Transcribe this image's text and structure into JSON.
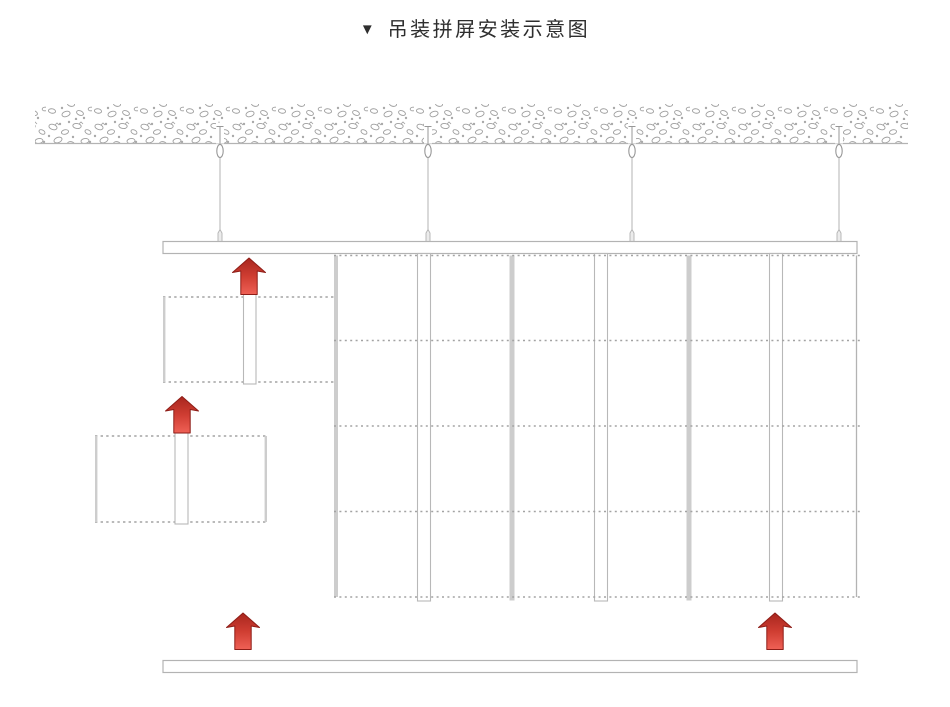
{
  "title": {
    "marker": "▼",
    "text": "吊装拼屏安装示意图"
  },
  "colors": {
    "background": "#ffffff",
    "line": "#b3b3b3",
    "dash": "#a3a3a3",
    "gray_fill": "#cdcdcd",
    "texture": "#9e9e9e",
    "rail_stroke": "#b8b8b8",
    "anchor": "#979797",
    "arrow_dark": "#a8261e",
    "arrow_mid": "#cf3d32",
    "arrow_light": "#ef6156",
    "arrow_stroke": "#8e1d17"
  },
  "diagram": {
    "ceiling": {
      "x": 35,
      "y": 104,
      "width": 873,
      "height": 39
    },
    "hangers": {
      "xs": [
        220,
        428,
        632,
        839
      ],
      "pin_top_y": 126.5,
      "ceiling_line_y": 143.5,
      "eyebolt_cy": 151,
      "eyebolt_ry": 6.6,
      "rod_bottom_y": 232,
      "ferrule_top_y": 229.5,
      "ferrule_bottom_y": 242.5
    },
    "suspension_beam": {
      "x": 163,
      "y": 241.5,
      "width": 694,
      "height": 12
    },
    "screen_grid": {
      "x": 334,
      "x2": 863,
      "right_edge_x": 856.5,
      "top": 255.5,
      "bottom": 597,
      "row_lines_y": [
        255.5,
        340.5,
        426,
        511.5,
        597
      ],
      "left_bar": {
        "x": 334,
        "width": 4
      },
      "gray_bar_xs": [
        509.5,
        686.5
      ],
      "gray_bar_width": 5,
      "rail_xs": [
        417,
        594,
        769
      ],
      "rail_width": 13,
      "rail_top": 253.5,
      "rail_bottom": 601
    },
    "staging_panels": [
      {
        "box": {
          "x": 163,
          "y": 297,
          "width": 171,
          "height": 85
        },
        "solid_edge_xs": [
          164.2
        ],
        "rail": {
          "x": 243.5,
          "width": 12.5,
          "top": 294,
          "bottom": 384
        }
      },
      {
        "box": {
          "x": 95,
          "y": 436,
          "width": 172,
          "height": 86
        },
        "solid_edge_xs": [
          96.2,
          265.8
        ],
        "rail": {
          "x": 175,
          "width": 13,
          "top": 433,
          "bottom": 524
        }
      }
    ],
    "bottom_bar": {
      "x": 163,
      "y": 660.5,
      "width": 694,
      "height": 12
    },
    "arrows": [
      {
        "cx": 249,
        "tip_y": 258
      },
      {
        "cx": 182,
        "tip_y": 396.5
      },
      {
        "cx": 243,
        "tip_y": 613
      },
      {
        "cx": 775,
        "tip_y": 613
      }
    ]
  }
}
